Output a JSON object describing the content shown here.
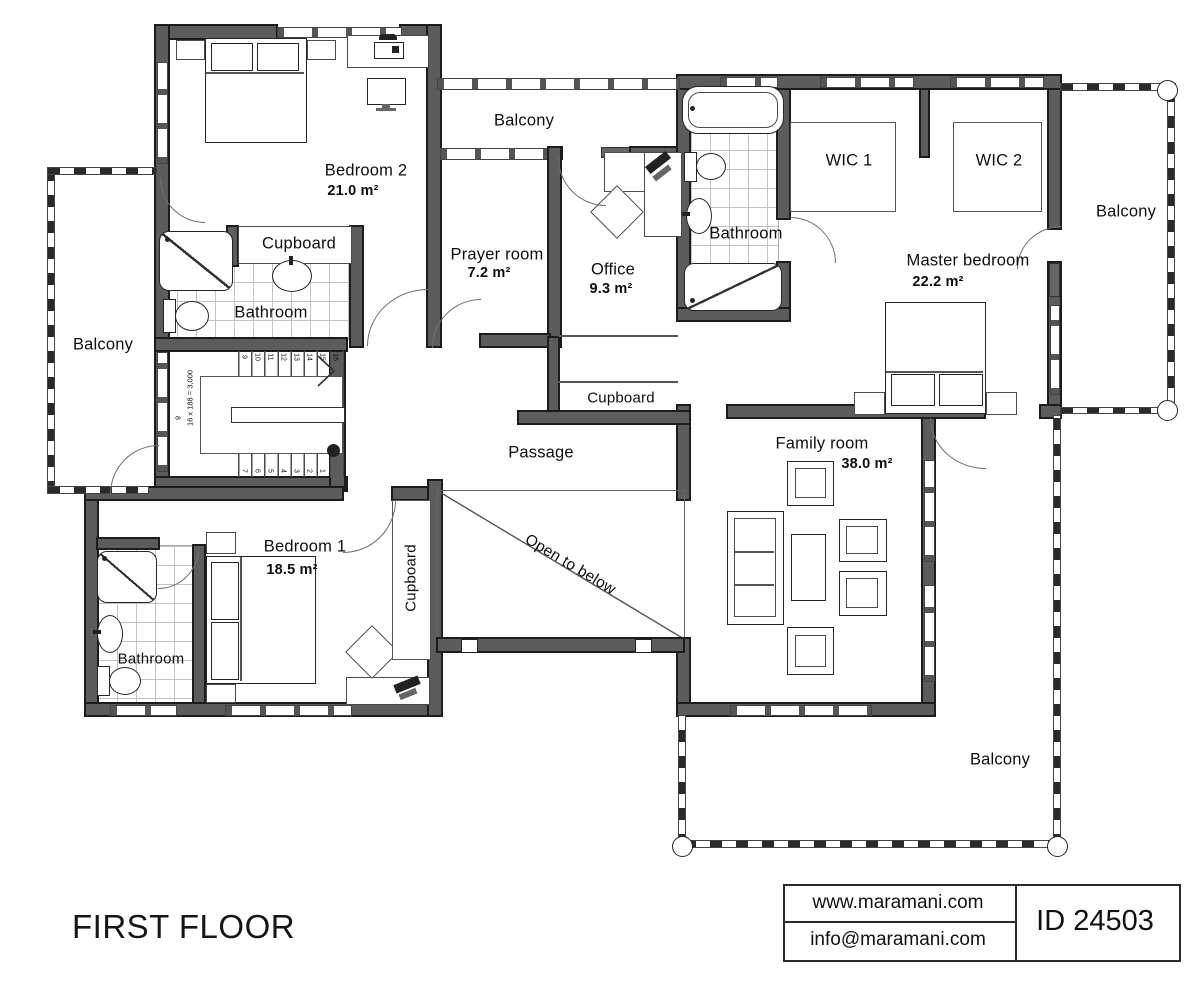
{
  "title": "FIRST FLOOR",
  "footer": {
    "website": "www.maramani.com",
    "email": "info@maramani.com",
    "plan_id": "ID 24503"
  },
  "colors": {
    "wall": "#5c5c5c",
    "line": "#262626"
  },
  "rooms": {
    "bedroom2": {
      "name": "Bedroom 2",
      "area": "21.0 m²"
    },
    "cupboard_top": {
      "name": "Cupboard"
    },
    "bathroom_upper_left": {
      "name": "Bathroom"
    },
    "balcony_left": {
      "name": "Balcony"
    },
    "balcony_top": {
      "name": "Balcony"
    },
    "prayer_room": {
      "name": "Prayer room",
      "area": "7.2 m²"
    },
    "office": {
      "name": "Office",
      "area": "9.3 m²"
    },
    "bathroom_top_right": {
      "name": "Bathroom"
    },
    "wic1": {
      "name": "WIC 1"
    },
    "wic2": {
      "name": "WIC 2"
    },
    "balcony_right": {
      "name": "Balcony"
    },
    "master_bedroom": {
      "name": "Master bedroom",
      "area": "22.2 m²"
    },
    "cupboard_middle": {
      "name": "Cupboard"
    },
    "passage": {
      "name": "Passage"
    },
    "family_room": {
      "name": "Family room",
      "area": "38.0 m²"
    },
    "bedroom1": {
      "name": "Bedroom 1",
      "area": "18.5 m²"
    },
    "cupboard_bedroom1": {
      "name": "Cupboard"
    },
    "bathroom_lower_left": {
      "name": "Bathroom"
    },
    "open_to_below": {
      "name": "Open to below"
    },
    "balcony_bottom": {
      "name": "Balcony"
    }
  },
  "stairs": {
    "note": "16 x 188 = 3,000",
    "upper_flight": [
      "9",
      "10",
      "11",
      "12",
      "13",
      "14",
      "15",
      "16"
    ],
    "lower_flight": [
      "7",
      "6",
      "5",
      "4",
      "3",
      "2",
      "1"
    ],
    "landing_step": "8"
  }
}
